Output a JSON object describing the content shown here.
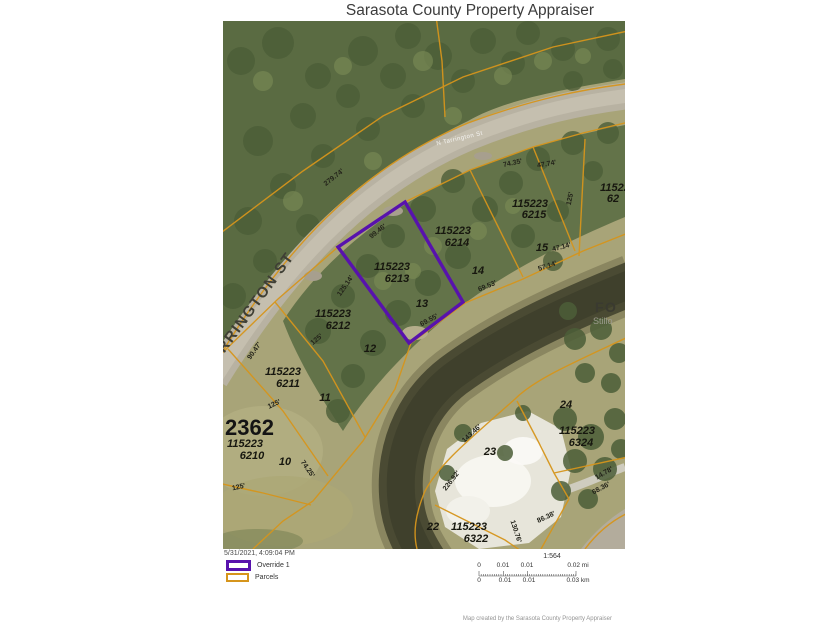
{
  "title": "Sarasota County Property Appraiser",
  "map": {
    "street_name_large": "TARRINGTON ST",
    "street_name_on_road": "N Tarrington St",
    "water_label": {
      "line1": "FO",
      "line2": "Stillo"
    },
    "area_number": "2362",
    "parcel_id_labels": [
      {
        "id": [
          "115223",
          "6213"
        ],
        "pos": [
          [
            169,
            249
          ],
          [
            174,
            261
          ]
        ]
      },
      {
        "id": [
          "115223",
          "6214"
        ],
        "pos": [
          [
            230,
            213
          ],
          [
            234,
            225
          ]
        ]
      },
      {
        "id": [
          "115223",
          "6215"
        ],
        "pos": [
          [
            307,
            186
          ],
          [
            311,
            197
          ]
        ]
      },
      {
        "id": [
          "115223",
          "62"
        ],
        "pos": [
          [
            395,
            170
          ],
          [
            390,
            181
          ]
        ]
      },
      {
        "id": [
          "115223",
          "6212"
        ],
        "pos": [
          [
            110,
            296
          ],
          [
            115,
            308
          ]
        ]
      },
      {
        "id": [
          "115223",
          "6211"
        ],
        "pos": [
          [
            60,
            354
          ],
          [
            65,
            366
          ]
        ]
      },
      {
        "id": [
          "115223",
          "6210"
        ],
        "pos": [
          [
            22,
            426
          ],
          [
            29,
            438
          ]
        ]
      },
      {
        "id": [
          "115223",
          "6324"
        ],
        "pos": [
          [
            354,
            413
          ],
          [
            358,
            425
          ]
        ]
      },
      {
        "id": [
          "115223",
          "6322"
        ],
        "pos": [
          [
            246,
            509
          ],
          [
            253,
            521
          ]
        ]
      }
    ],
    "lot_numbers": [
      {
        "n": "13",
        "x": 199,
        "y": 286
      },
      {
        "n": "14",
        "x": 255,
        "y": 253
      },
      {
        "n": "15",
        "x": 319,
        "y": 230
      },
      {
        "n": "12",
        "x": 147,
        "y": 331
      },
      {
        "n": "11",
        "x": 102,
        "y": 380
      },
      {
        "n": "10",
        "x": 62,
        "y": 444
      },
      {
        "n": "23",
        "x": 267,
        "y": 434
      },
      {
        "n": "22",
        "x": 210,
        "y": 509
      },
      {
        "n": "24",
        "x": 343,
        "y": 387
      }
    ],
    "dimension_labels": [
      {
        "t": "279.74'",
        "x": 112,
        "y": 158,
        "r": -38
      },
      {
        "t": "99.46'",
        "x": 156,
        "y": 212,
        "r": -38
      },
      {
        "t": "90.47'",
        "x": 33,
        "y": 331,
        "r": -55
      },
      {
        "t": "125'",
        "x": 95,
        "y": 320,
        "r": -40
      },
      {
        "t": "125'",
        "x": 52,
        "y": 385,
        "r": -25
      },
      {
        "t": "125'",
        "x": 16,
        "y": 468,
        "r": -12
      },
      {
        "t": "74.25'",
        "x": 83,
        "y": 449,
        "r": 55
      },
      {
        "t": "125.14'",
        "x": 124,
        "y": 266,
        "r": -55
      },
      {
        "t": "69.55'",
        "x": 207,
        "y": 301,
        "r": -28
      },
      {
        "t": "69.53'",
        "x": 265,
        "y": 267,
        "r": -22
      },
      {
        "t": "57.14'",
        "x": 325,
        "y": 247,
        "r": -18
      },
      {
        "t": "47.14'",
        "x": 339,
        "y": 228,
        "r": -15
      },
      {
        "t": "74.35'",
        "x": 290,
        "y": 144,
        "r": -12
      },
      {
        "t": "47.74'",
        "x": 324,
        "y": 145,
        "r": -10
      },
      {
        "t": "125'",
        "x": 349,
        "y": 178,
        "r": -78
      },
      {
        "t": "226.92'",
        "x": 230,
        "y": 461,
        "r": -52
      },
      {
        "t": "130.76'",
        "x": 291,
        "y": 511,
        "r": 72
      },
      {
        "t": "86.38'",
        "x": 324,
        "y": 498,
        "r": -25
      },
      {
        "t": "143.46'",
        "x": 250,
        "y": 414,
        "r": -42
      },
      {
        "t": "14.78'",
        "x": 382,
        "y": 454,
        "r": -30
      },
      {
        "t": "68.36'",
        "x": 379,
        "y": 469,
        "r": -28
      }
    ]
  },
  "legend": {
    "timestamp": "5/31/2021, 4:09:04 PM",
    "items": [
      {
        "label": "Override 1",
        "color": "#5812ad"
      },
      {
        "label": "Parcels",
        "color": "#d6951c"
      }
    ]
  },
  "scalebar": {
    "ratio": "1:564",
    "mi_labels": [
      "0",
      "0.01",
      "0.01",
      "0.02 mi"
    ],
    "km_labels": [
      "0",
      "0.01",
      "0.01",
      "0.03 km"
    ]
  },
  "footer": "Map created by the Sarasota County Property Appraiser"
}
